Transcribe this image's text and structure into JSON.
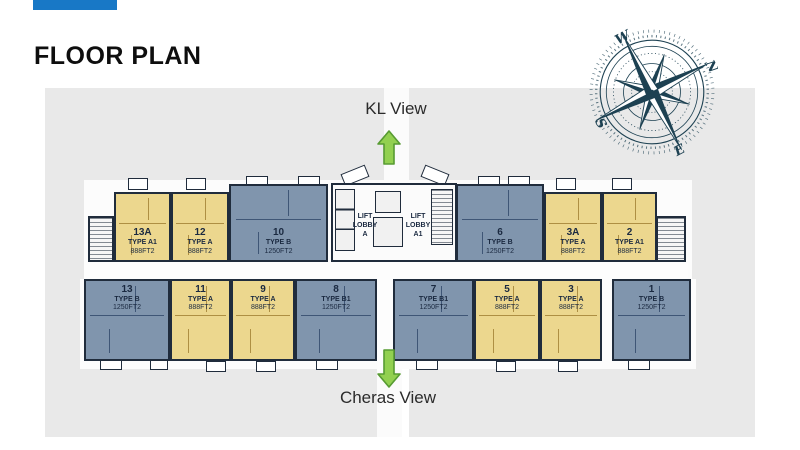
{
  "slide": {
    "title": "FLOOR PLAN"
  },
  "views": {
    "top_label": "KL View",
    "bottom_label": "Cheras View"
  },
  "compass": {
    "n": "N",
    "e": "E",
    "s": "S",
    "w": "W"
  },
  "lift_lobby": {
    "left": [
      "LIFT",
      "LOBBY",
      "A"
    ],
    "right": [
      "LIFT",
      "LOBBY",
      "A1"
    ]
  },
  "colors": {
    "accent_bar": "#1878c6",
    "type_a_fill": "#ecd78e",
    "type_b_fill": "#8095ad",
    "wall": "#202c3c",
    "background_gray": "#e9e9e9",
    "arrow_green": "#92d050",
    "compass_ink": "#1d4152"
  },
  "units": [
    {
      "no": "13A",
      "type": "TYPE A1",
      "size": "888FT2",
      "category": "A",
      "row": "top"
    },
    {
      "no": "12",
      "type": "TYPE A",
      "size": "888FT2",
      "category": "A",
      "row": "top"
    },
    {
      "no": "10",
      "type": "TYPE B",
      "size": "1250FT2",
      "category": "B",
      "row": "top"
    },
    {
      "no": "6",
      "type": "TYPE B",
      "size": "1250FT2",
      "category": "B",
      "row": "top"
    },
    {
      "no": "3A",
      "type": "TYPE A",
      "size": "888FT2",
      "category": "A",
      "row": "top"
    },
    {
      "no": "2",
      "type": "TYPE A1",
      "size": "888FT2",
      "category": "A",
      "row": "top"
    },
    {
      "no": "13",
      "type": "TYPE B",
      "size": "1250FT2",
      "category": "B",
      "row": "bottom"
    },
    {
      "no": "11",
      "type": "TYPE A",
      "size": "888FT2",
      "category": "A",
      "row": "bottom"
    },
    {
      "no": "9",
      "type": "TYPE A",
      "size": "888FT2",
      "category": "A",
      "row": "bottom"
    },
    {
      "no": "8",
      "type": "TYPE B1",
      "size": "1250FT2",
      "category": "B",
      "row": "bottom"
    },
    {
      "no": "7",
      "type": "TYPE B1",
      "size": "1250FT2",
      "category": "B",
      "row": "bottom"
    },
    {
      "no": "5",
      "type": "TYPE A",
      "size": "888FT2",
      "category": "A",
      "row": "bottom"
    },
    {
      "no": "3",
      "type": "TYPE A",
      "size": "888FT2",
      "category": "A",
      "row": "bottom"
    },
    {
      "no": "1",
      "type": "TYPE B",
      "size": "1250FT2",
      "category": "B",
      "row": "bottom"
    }
  ]
}
